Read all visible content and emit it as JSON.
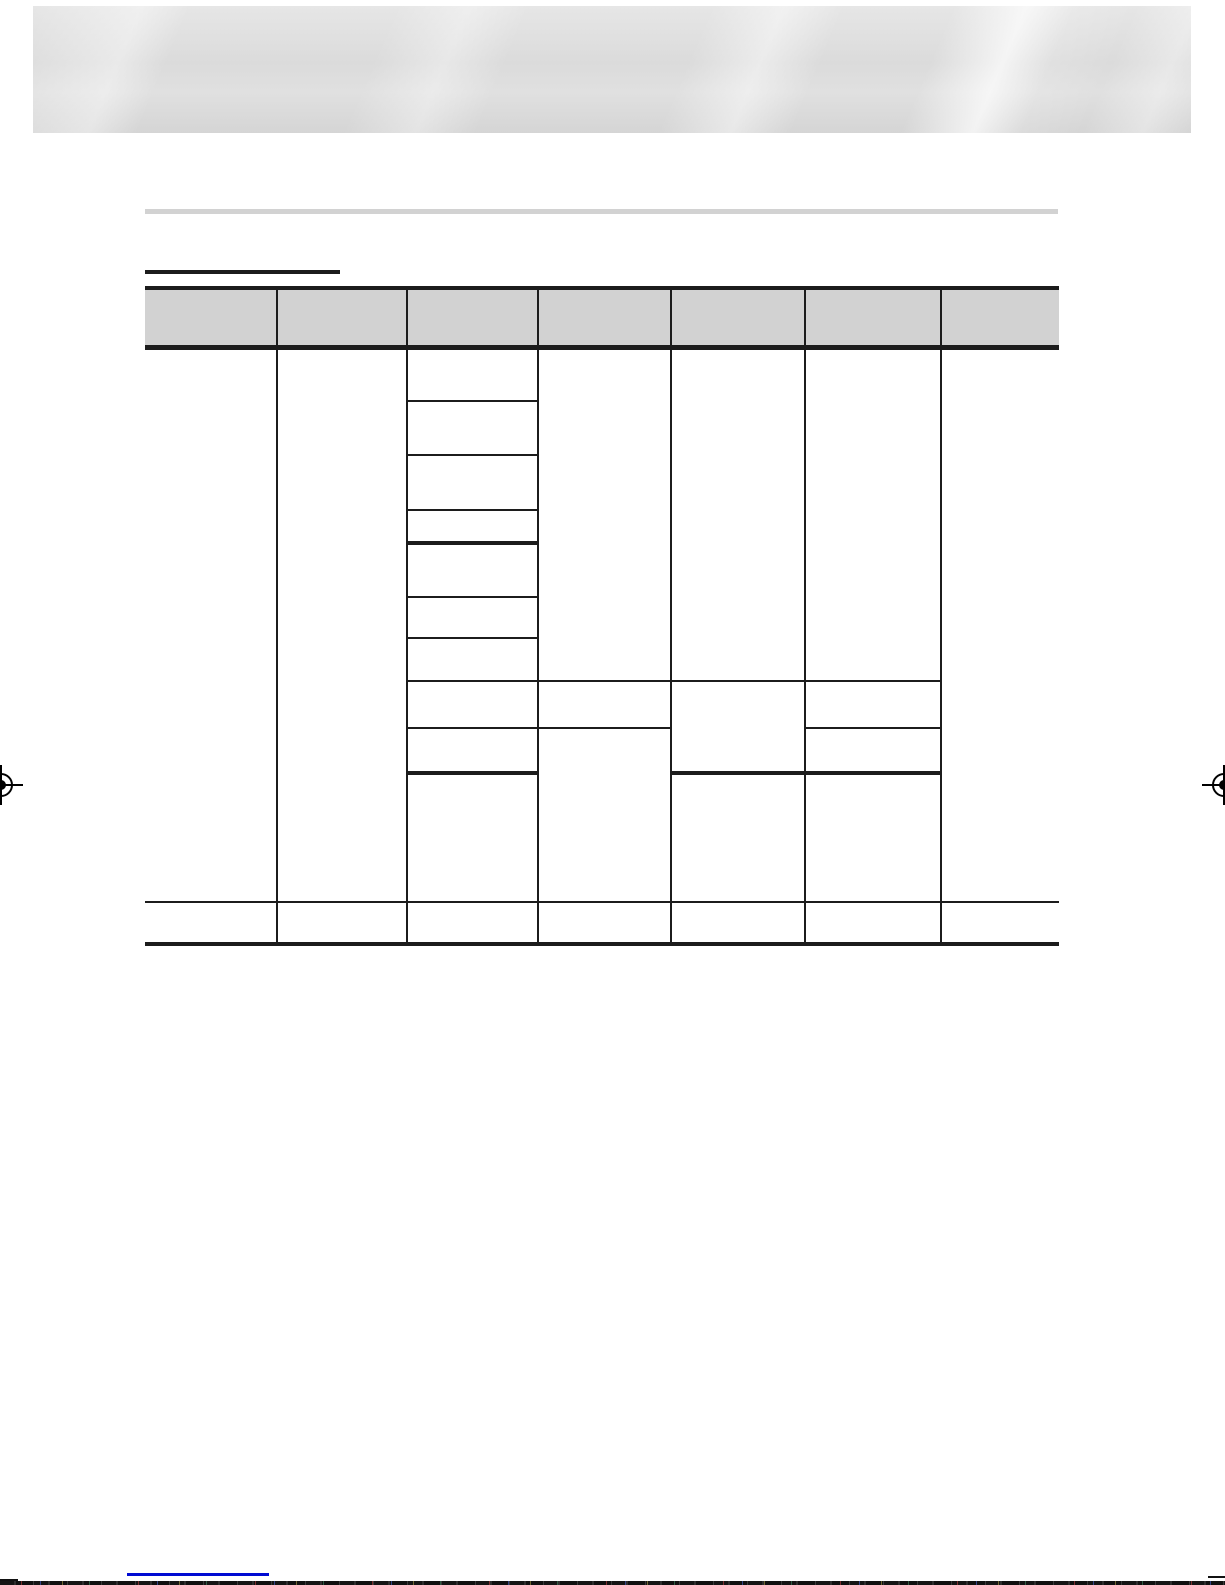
{
  "page": {
    "background": "#ffffff"
  },
  "top_banner": {
    "base_top": "#e6e6e6",
    "base_mid": "#dbdbdb",
    "base_bottom": "#d5d5d5"
  },
  "section_heading": {
    "gray_bar_color": "#d2d2d2",
    "title_rule_color": "#1c1c1c"
  },
  "spec_table": {
    "header_bg": "#d2d2d2",
    "line_color": "#1c1c1c",
    "columns_px": [
      132,
      130,
      131,
      133,
      134,
      136,
      118
    ],
    "header_height_px": 55,
    "row_heights_px": [
      53,
      54,
      55,
      33,
      54,
      41,
      43,
      47,
      45,
      129,
      42
    ],
    "header_cell_count": 7,
    "body_cells": [
      [
        {
          "c": 1,
          "rs": 10
        },
        {
          "c": 2,
          "rs": 10
        },
        {
          "c": 3
        },
        {
          "c": 4,
          "rs": 7
        },
        {
          "c": 5,
          "rs": 7
        },
        {
          "c": 6,
          "rs": 7
        },
        {
          "c": 7,
          "rs": 10
        }
      ],
      [
        {
          "c": 3
        }
      ],
      [
        {
          "c": 3
        }
      ],
      [
        {
          "c": 3,
          "tb": 1
        }
      ],
      [
        {
          "c": 3
        }
      ],
      [
        {
          "c": 3
        }
      ],
      [
        {
          "c": 3
        }
      ],
      [
        {
          "c": 3
        },
        {
          "c": 4
        },
        {
          "c": 5,
          "rs": 2,
          "tb": 1
        },
        {
          "c": 6
        }
      ],
      [
        {
          "c": 3,
          "tb": 1
        },
        {
          "c": 4,
          "rs": 2
        },
        {
          "c": 6,
          "tb": 1
        }
      ],
      [
        {
          "c": 3
        },
        {
          "c": 5
        },
        {
          "c": 6
        }
      ],
      [
        {
          "c": 1,
          "tb": 1
        },
        {
          "c": 2,
          "tb": 1
        },
        {
          "c": 3,
          "tb": 1
        },
        {
          "c": 4,
          "tb": 1
        },
        {
          "c": 5,
          "tb": 1
        },
        {
          "c": 6,
          "tb": 1
        },
        {
          "c": 7,
          "tb": 1
        }
      ]
    ]
  },
  "registration_marks": {
    "color": "#000000",
    "positions": [
      "left-edge",
      "right-edge"
    ]
  },
  "page_bottom": {
    "link_underline_color": "#000ad2",
    "edge_tick_color": "#111111",
    "noise_strip_base": "#141414"
  }
}
